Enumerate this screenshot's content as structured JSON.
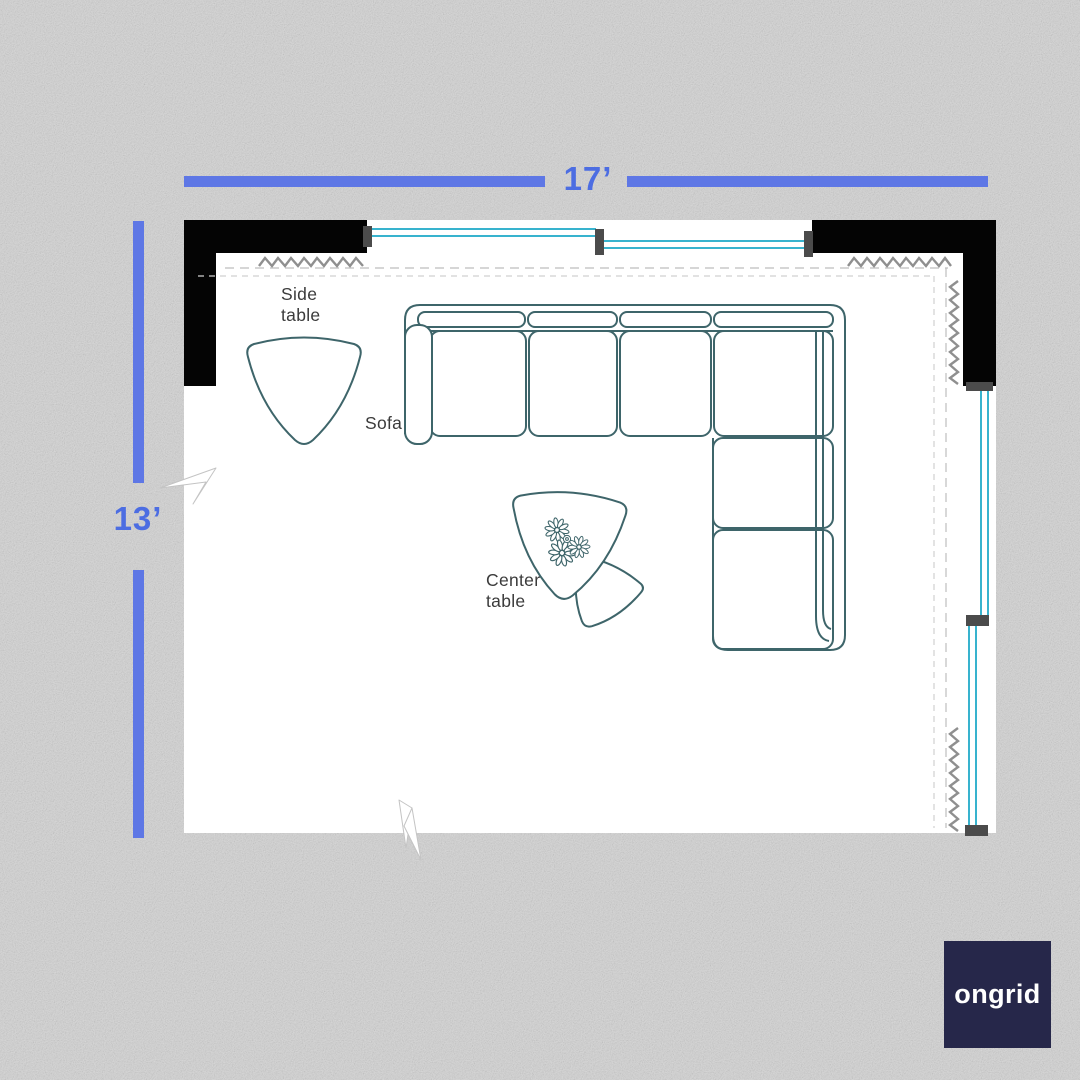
{
  "dimensions": {
    "width": "17’",
    "height": "13’"
  },
  "furniture_labels": {
    "side_table": "Side table",
    "sofa": "Sofa",
    "center_table": "Center table"
  },
  "logo": {
    "text": "ongrid"
  },
  "colors": {
    "background": "#d6d6d6",
    "room_fill": "#ffffff",
    "wall": "#040404",
    "dimension_blue": "#5e77e5",
    "dimension_text_blue": "#4c6de2",
    "window_teal": "#38b3ce",
    "mullion_gray": "#4b4b4b",
    "furniture_outline": "#3e656a",
    "insulation_zigzag_gray": "#8f8f8f",
    "label_text": "#3b3b3b",
    "logo_background": "#26274a",
    "logo_text_color": "#ffffff"
  }
}
